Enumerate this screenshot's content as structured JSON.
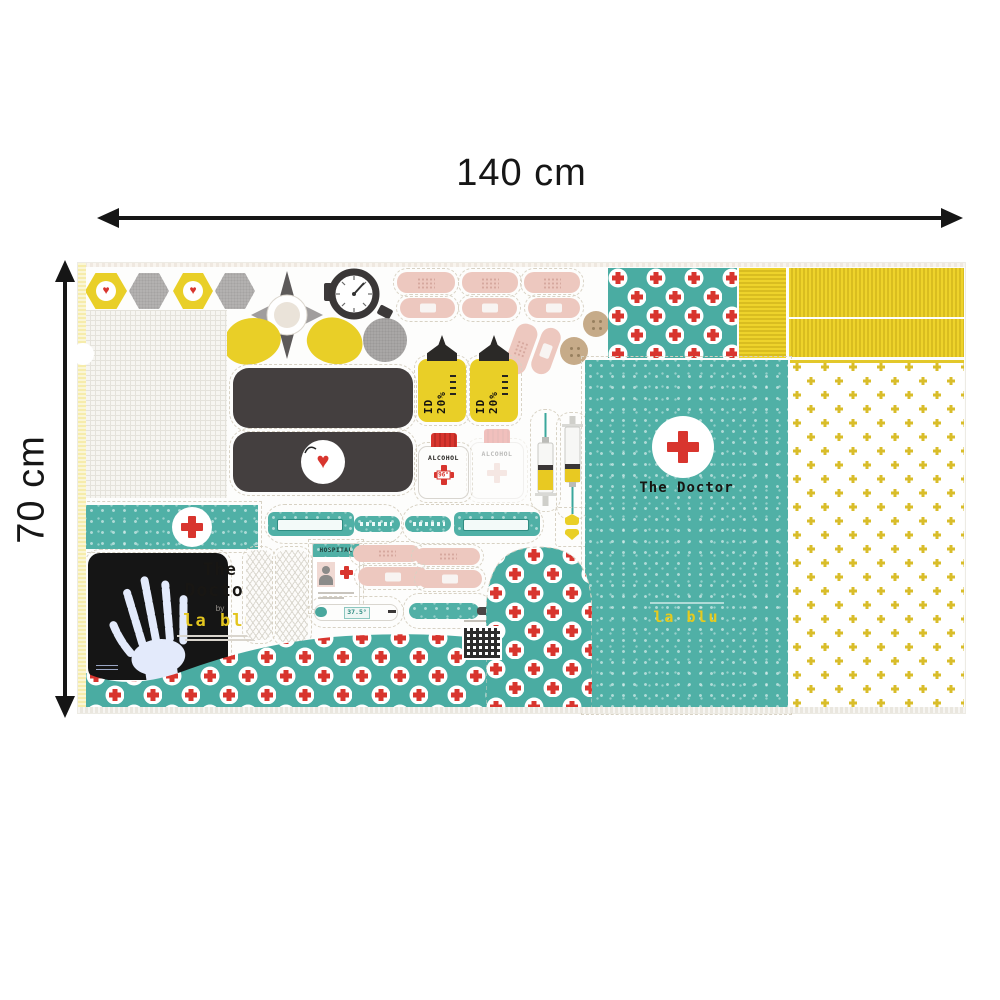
{
  "annotations": {
    "width_label": "140 cm",
    "height_label": "70 cm"
  },
  "panel": {
    "icons": {
      "heart": "♥"
    },
    "logo": {
      "line1": "The",
      "line2": "Doctor",
      "by": "by",
      "brand": "la blu"
    },
    "doctor_badge": {
      "label": "The Doctor"
    },
    "bottles": {
      "id_label": "ID 20%",
      "alcohol_label": "ALCOHOL",
      "alcohol_degree": "96°"
    },
    "id_card": {
      "title": "HOSPITAL"
    },
    "thermometer": {
      "reading": "37.5°"
    },
    "colors": {
      "teal": "#50b0a6",
      "red": "#d8352e",
      "yellow": "#e9cf27",
      "plus_yellow": "#d9bd2a",
      "pink": "#edc8bf",
      "dark": "#443f3f",
      "tan": "#c6ab89",
      "selvage": "#f6ecab"
    }
  }
}
